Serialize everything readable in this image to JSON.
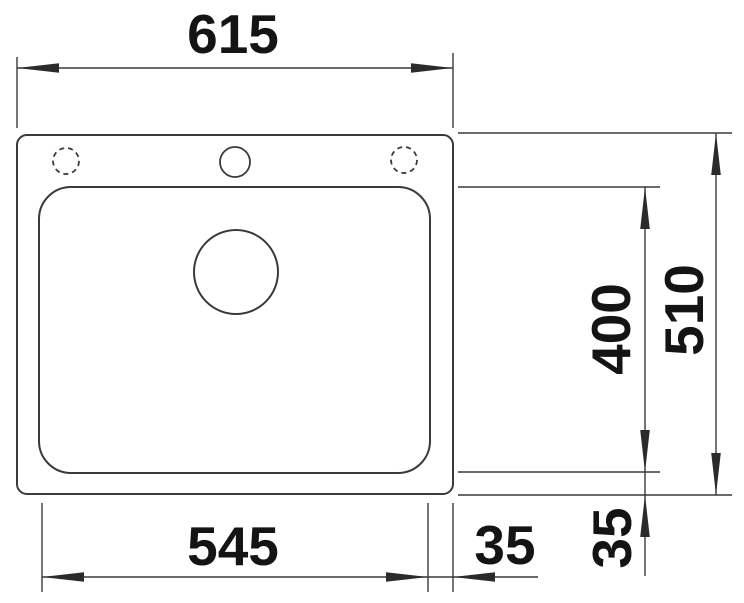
{
  "drawing": {
    "type": "technical-dimension-drawing",
    "subject": "kitchen-sink-top-view",
    "units": "mm",
    "colors": {
      "background": "#ffffff",
      "line": "#3a3a3a",
      "text": "#141414"
    },
    "dimensions": {
      "overall_width": "615",
      "overall_depth": "510",
      "bowl_width": "545",
      "bowl_depth": "400",
      "bowl_side_offset": "35",
      "bowl_bottom_offset": "35"
    },
    "features": {
      "tap_holes": {
        "center_hole": "drilled",
        "left_hole": "optional (dashed)",
        "right_hole": "optional (dashed)"
      },
      "drain": "round waste hole"
    }
  }
}
